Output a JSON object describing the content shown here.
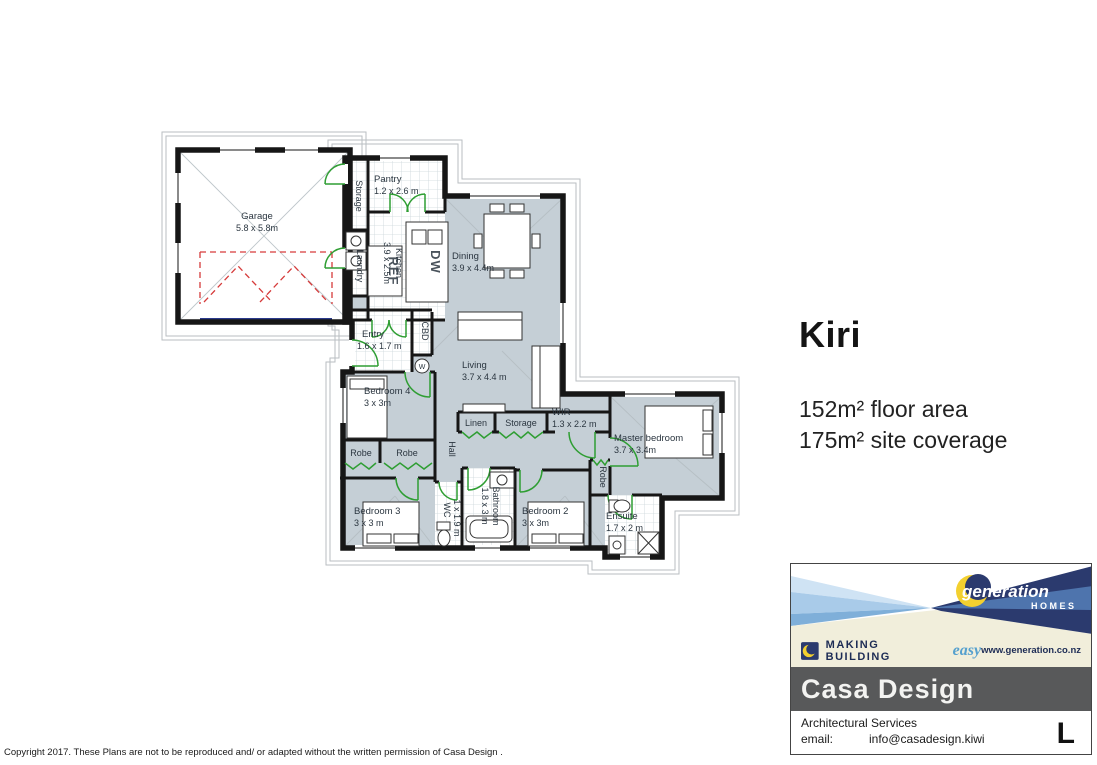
{
  "plan": {
    "title": "Kiri",
    "floor_area": "152m² floor area",
    "site_coverage": "175m² site coverage"
  },
  "rooms": {
    "garage": {
      "name": "Garage",
      "dims": "5.8 x 5.8m"
    },
    "storage_top": {
      "name": "Storage"
    },
    "pantry": {
      "name": "Pantry",
      "dims": "1.2 x 2.6 m"
    },
    "kitchen": {
      "name": "Kitchen",
      "dims": "3.9 x 2.5m"
    },
    "laundry": {
      "name": "Laundry"
    },
    "fridge": {
      "name": "REF"
    },
    "dishwasher": {
      "name": "DW"
    },
    "dining": {
      "name": "Dining",
      "dims": "3.9 x 4.4m"
    },
    "living": {
      "name": "Living",
      "dims": "3.7 x 4.4 m"
    },
    "entry": {
      "name": "Entry",
      "dims": "1.6 x 1.7 m"
    },
    "cbd": {
      "name": "CBD"
    },
    "hw": {
      "name": "W"
    },
    "bedroom4": {
      "name": "Bedroom 4",
      "dims": "3 x 3m"
    },
    "robe_a": {
      "name": "Robe"
    },
    "robe_b": {
      "name": "Robe"
    },
    "hall": {
      "name": "Hall"
    },
    "linen": {
      "name": "Linen"
    },
    "storage_hall": {
      "name": "Storage"
    },
    "wir": {
      "name": "WIR",
      "dims": "1.3 x 2.2 m"
    },
    "master": {
      "name": "Master bedroom",
      "dims": "3.7 x 3.4m"
    },
    "robe_master": {
      "name": "Robe"
    },
    "bedroom3": {
      "name": "Bedroom 3",
      "dims": "3 x 3 m"
    },
    "wc": {
      "name": "WC",
      "dims": "1 x 1.9 m"
    },
    "bathroom": {
      "name": "Bathroom",
      "dims": "1.8 x 3 m"
    },
    "bedroom2": {
      "name": "Bedroom 2",
      "dims": "3 x 3m"
    },
    "ensuite": {
      "name": "Ensuite",
      "dims": "1.7 x 2 m"
    }
  },
  "branding": {
    "generation_name": "generation",
    "generation_homes": "HOMES",
    "tagline_caps": "MAKING BUILDING",
    "tagline_script": "easy",
    "website": "www.generation.co.nz",
    "casa_title": "Casa Design",
    "casa_subtitle": "Architectural Services",
    "email_label": "email:",
    "email_value": "info@casadesign.kiwi",
    "sheet_letter": "L"
  },
  "footer": {
    "copyright": "Copyright 2017. These Plans are not to be reproduced and/ or adapted without the written permission of Casa Design ."
  },
  "colors": {
    "carpet": "#c5cfd6",
    "door_green": "#2f9e33",
    "wall": "#161616",
    "roof_line": "#b9bec2",
    "garage_red": "#d63b3b",
    "garage_door_blue": "#2b3a8c",
    "banner_navy": "#2b3a6e",
    "banner_blue": "#5b9bd5",
    "cream": "#f1eedb",
    "casa_gray": "#58595a",
    "logo_yellow": "#f3d02f"
  }
}
